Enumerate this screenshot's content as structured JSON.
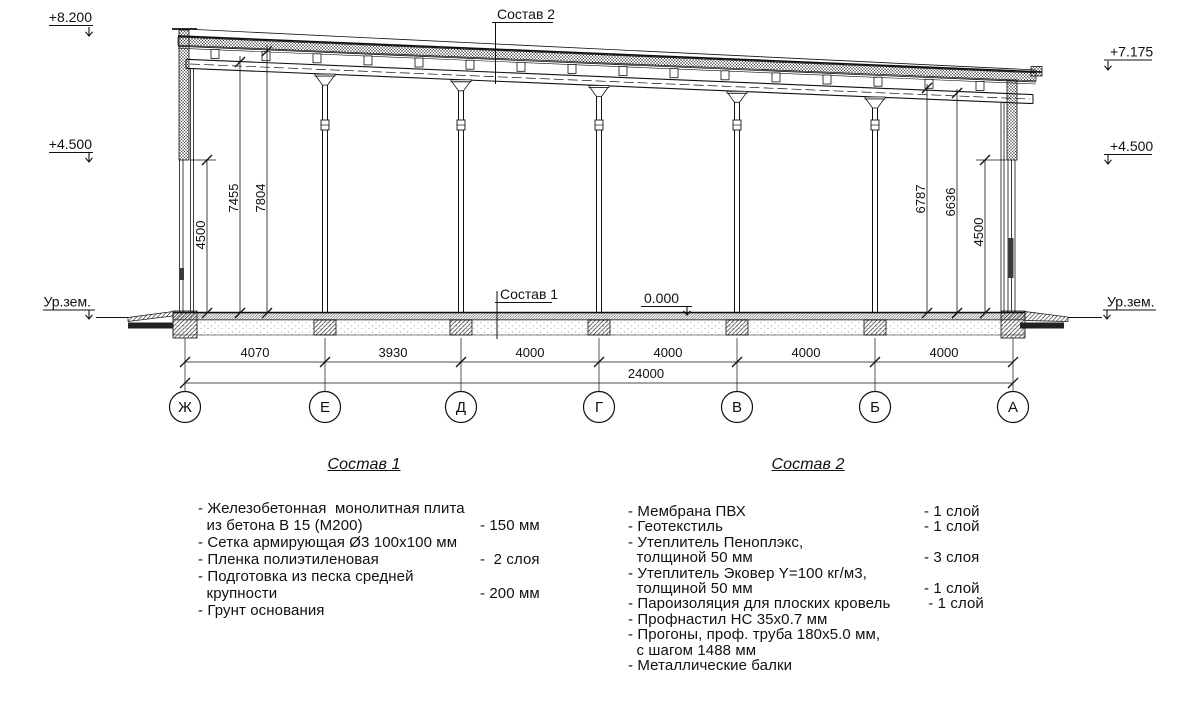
{
  "drawing": {
    "elevation_marks": {
      "top_left": "+8.200",
      "left_450": "+4.500",
      "ground_left": "Ур.зем.",
      "top_right": "+7.175",
      "right_450": "+4.500",
      "ground_right": "Ур.зем.",
      "zero_level": "0.000"
    },
    "callouts": {
      "roof_composition": "Состав 2",
      "floor_composition": "Состав 1"
    },
    "vertical_dimensions_left": [
      "4500",
      "7455",
      "7804"
    ],
    "vertical_dimensions_right": [
      "6787",
      "6636",
      "4500"
    ],
    "bay_dimensions": [
      "4070",
      "3930",
      "4000",
      "4000",
      "4000",
      "4000"
    ],
    "total_dimension": "24000",
    "grid_axes": [
      "Ж",
      "Е",
      "Д",
      "Г",
      "В",
      "Б",
      "А"
    ]
  },
  "composition_1": {
    "title": "Состав 1",
    "rows": [
      {
        "text": "- Железобетонная  монолитная плита",
        "value": ""
      },
      {
        "text": "  из бетона В 15 (М200)",
        "value": "- 150 мм"
      },
      {
        "text": "- Сетка армирующая Ø3 100x100 мм",
        "value": ""
      },
      {
        "text": "- Пленка полиэтиленовая",
        "value": "-  2 слоя"
      },
      {
        "text": "- Подготовка из песка средней",
        "value": ""
      },
      {
        "text": "  крупности",
        "value": "- 200 мм"
      },
      {
        "text": "- Грунт основания",
        "value": ""
      }
    ]
  },
  "composition_2": {
    "title": "Состав 2",
    "rows": [
      {
        "text": "- Мембрана ПВХ",
        "value": "- 1 слой"
      },
      {
        "text": "- Геотекстиль",
        "value": "- 1 слой"
      },
      {
        "text": "- Утеплитель Пеноплэкс,",
        "value": ""
      },
      {
        "text": "  толщиной 50 мм",
        "value": "- 3 слоя"
      },
      {
        "text": "- Утеплитель Эковер Y=100 кг/м3,",
        "value": ""
      },
      {
        "text": "  толщиной 50 мм",
        "value": "- 1 слой"
      },
      {
        "text": "- Пароизоляция для плоских кровель",
        "value": " - 1 слой"
      },
      {
        "text": "- Профнастил НС 35x0.7 мм",
        "value": ""
      },
      {
        "text": "- Прогоны, проф. труба 180x5.0 мм,",
        "value": ""
      },
      {
        "text": "  с шагом 1488 мм",
        "value": ""
      },
      {
        "text": "- Металлические балки",
        "value": ""
      }
    ]
  }
}
